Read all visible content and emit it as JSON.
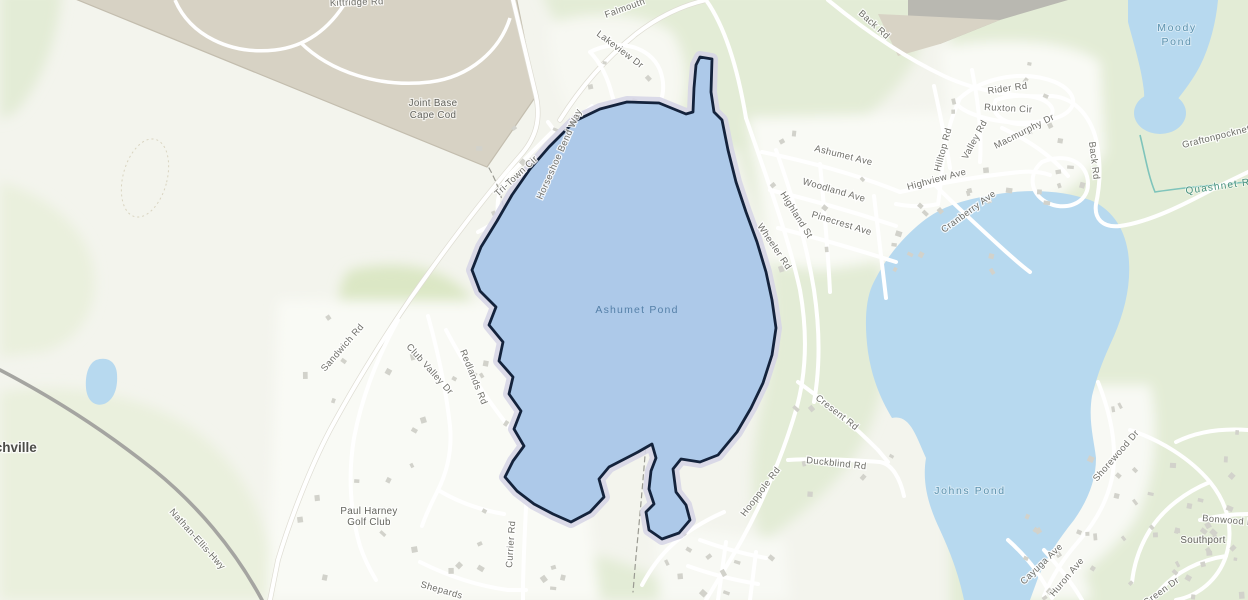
{
  "map": {
    "selected_feature": "Ashumet Pond",
    "labels": {
      "kittridge_rd": "Kittridge Rd",
      "falmouth": "Falmouth",
      "lakeview_dr": "Lakeview Dr",
      "back_rd_top": "Back Rd",
      "moody_line1": "Moody",
      "moody_line2": "Pond",
      "joint_base_line1": "Joint Base",
      "joint_base_line2": "Cape Cod",
      "tri_town_cir": "Tri-Town Cir",
      "horseshoe_bend_way": "Horseshoe Bend Way",
      "sandwich_rd": "Sandwich Rd",
      "hatchville": "Hatchville",
      "nathan_ellis_hwy": "Nathan-Ellis-Hwy",
      "club_valley_dr": "Club Valley Dr",
      "redlands_rd": "Redlands Rd",
      "currier_rd": "Currier Rd",
      "shepards": "Shepards",
      "paul_harney_line1": "Paul Harney",
      "paul_harney_line2": "Golf Club",
      "ashumet_pond": "Ashumet Pond",
      "ashumet_ave": "Ashumet Ave",
      "woodland_ave": "Woodland Ave",
      "pinecrest_ave": "Pinecrest Ave",
      "highland_st": "Highland St",
      "wheeler_rd": "Wheeler Rd",
      "highview_ave": "Highview Ave",
      "hilltop_rd": "Hilltop Rd",
      "valley_rd": "Valley Rd",
      "rider_rd": "Rider Rd",
      "ruxton_cir": "Ruxton Cir",
      "macmurphy_dr": "Macmurphy Dr",
      "cranberry_ave": "Cranberry Ave",
      "back_rd_east": "Back Rd",
      "graftonpocknet": "Graftonpocknet",
      "quashnet_river": "Quashnet River",
      "johns_pond": "Johns Pond",
      "cresent_rd": "Cresent Rd",
      "duckblind_rd": "Duckblind Rd",
      "hooppole_rd": "Hooppole Rd",
      "shorewood_dr": "Shorewood Dr",
      "southport": "Southport",
      "bonwood_dr": "Bonwood Dr",
      "green_dr": "Green Dr",
      "cayuga_ave": "Cayuga Ave",
      "huron_ave": "Huron Ave"
    },
    "colors": {
      "selection_outline": "#14233c",
      "selection_halo": "#d6d5e6",
      "selected_water": "#adc9e9",
      "water": "#b7d9ef",
      "land": "#f3f4ed",
      "vegetation": "#e3ecd6",
      "golf_green": "#dbe7c5",
      "military_base": "#d7d2c4",
      "road_fill": "#ffffff",
      "highway": "#a5a5a1",
      "road_label_color": "#6e6e68",
      "water_label_color": "#5e93ae",
      "place_label_color": "#63635d"
    }
  }
}
